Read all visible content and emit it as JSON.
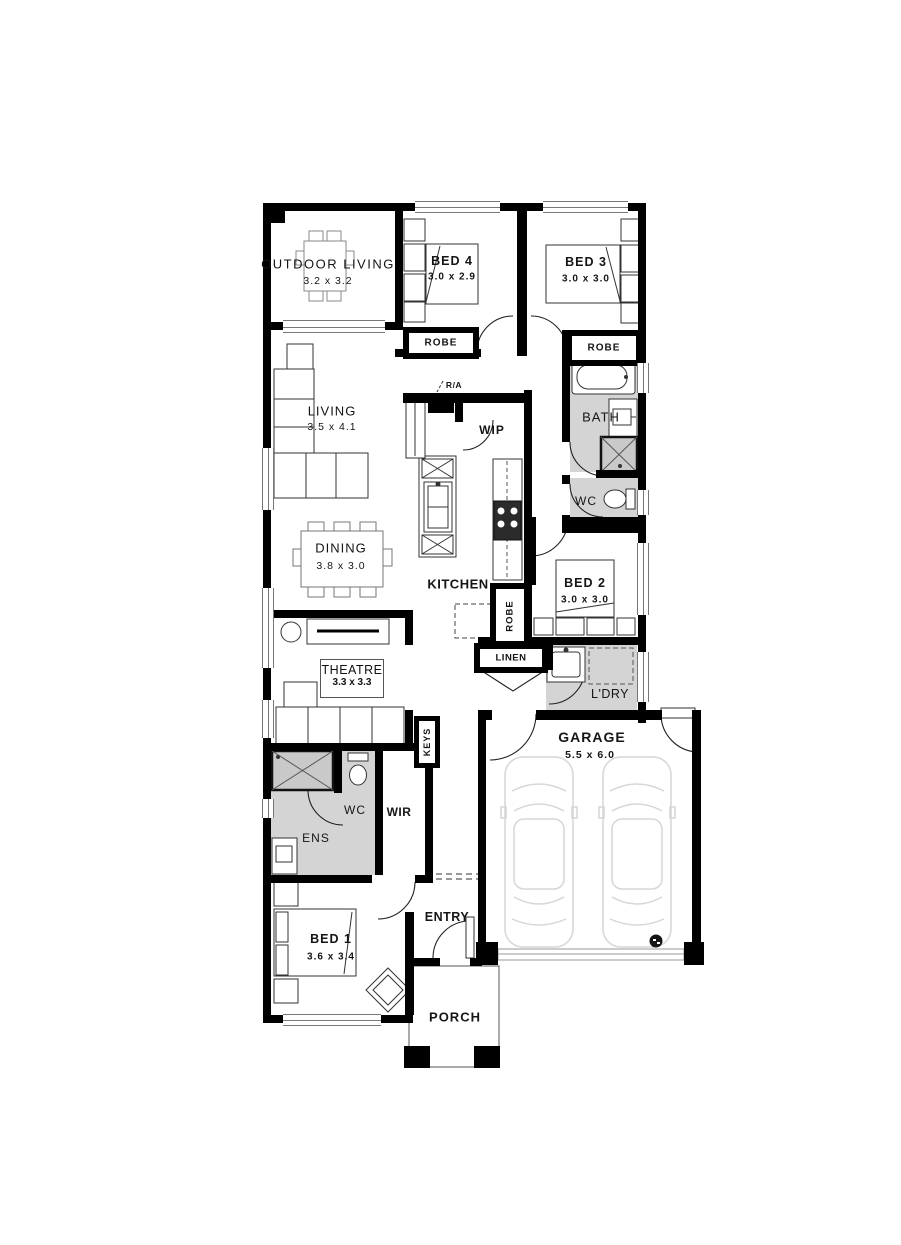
{
  "rooms": {
    "outdoor_living": {
      "label": "OUTDOOR LIVING",
      "dims": "3.2 x 3.2"
    },
    "bed4": {
      "label": "BED 4",
      "dims": "3.0 x 2.9"
    },
    "bed3": {
      "label": "BED 3",
      "dims": "3.0 x 3.0"
    },
    "living": {
      "label": "LIVING",
      "dims": "3.5 x 4.1"
    },
    "dining": {
      "label": "DINING",
      "dims": "3.8 x 3.0"
    },
    "kitchen": {
      "label": "KITCHEN"
    },
    "wip": {
      "label": "WIP"
    },
    "bath": {
      "label": "BATH"
    },
    "wc_main": {
      "label": "WC"
    },
    "bed2": {
      "label": "BED 2",
      "dims": "3.0 x 3.0"
    },
    "theatre": {
      "label": "THEATRE",
      "dims": "3.3 x 3.3"
    },
    "laundry": {
      "label": "L'DRY"
    },
    "garage": {
      "label": "GARAGE",
      "dims": "5.5 x 6.0"
    },
    "ens": {
      "label": "ENS"
    },
    "wc_ens": {
      "label": "WC"
    },
    "wir": {
      "label": "WIR"
    },
    "bed1": {
      "label": "BED 1",
      "dims": "3.6 x 3.4"
    },
    "entry": {
      "label": "ENTRY"
    },
    "porch": {
      "label": "PORCH"
    }
  },
  "storage": {
    "robe_bed4": "ROBE",
    "robe_bed3": "ROBE",
    "robe_bed2": "ROBE",
    "linen": "LINEN",
    "keys": "KEYS"
  },
  "annotations": {
    "return_air": "R/A"
  },
  "colors": {
    "wall": "#000000",
    "wet_floor": "#d4d4d4",
    "car_outline": "#d6d6d6"
  }
}
